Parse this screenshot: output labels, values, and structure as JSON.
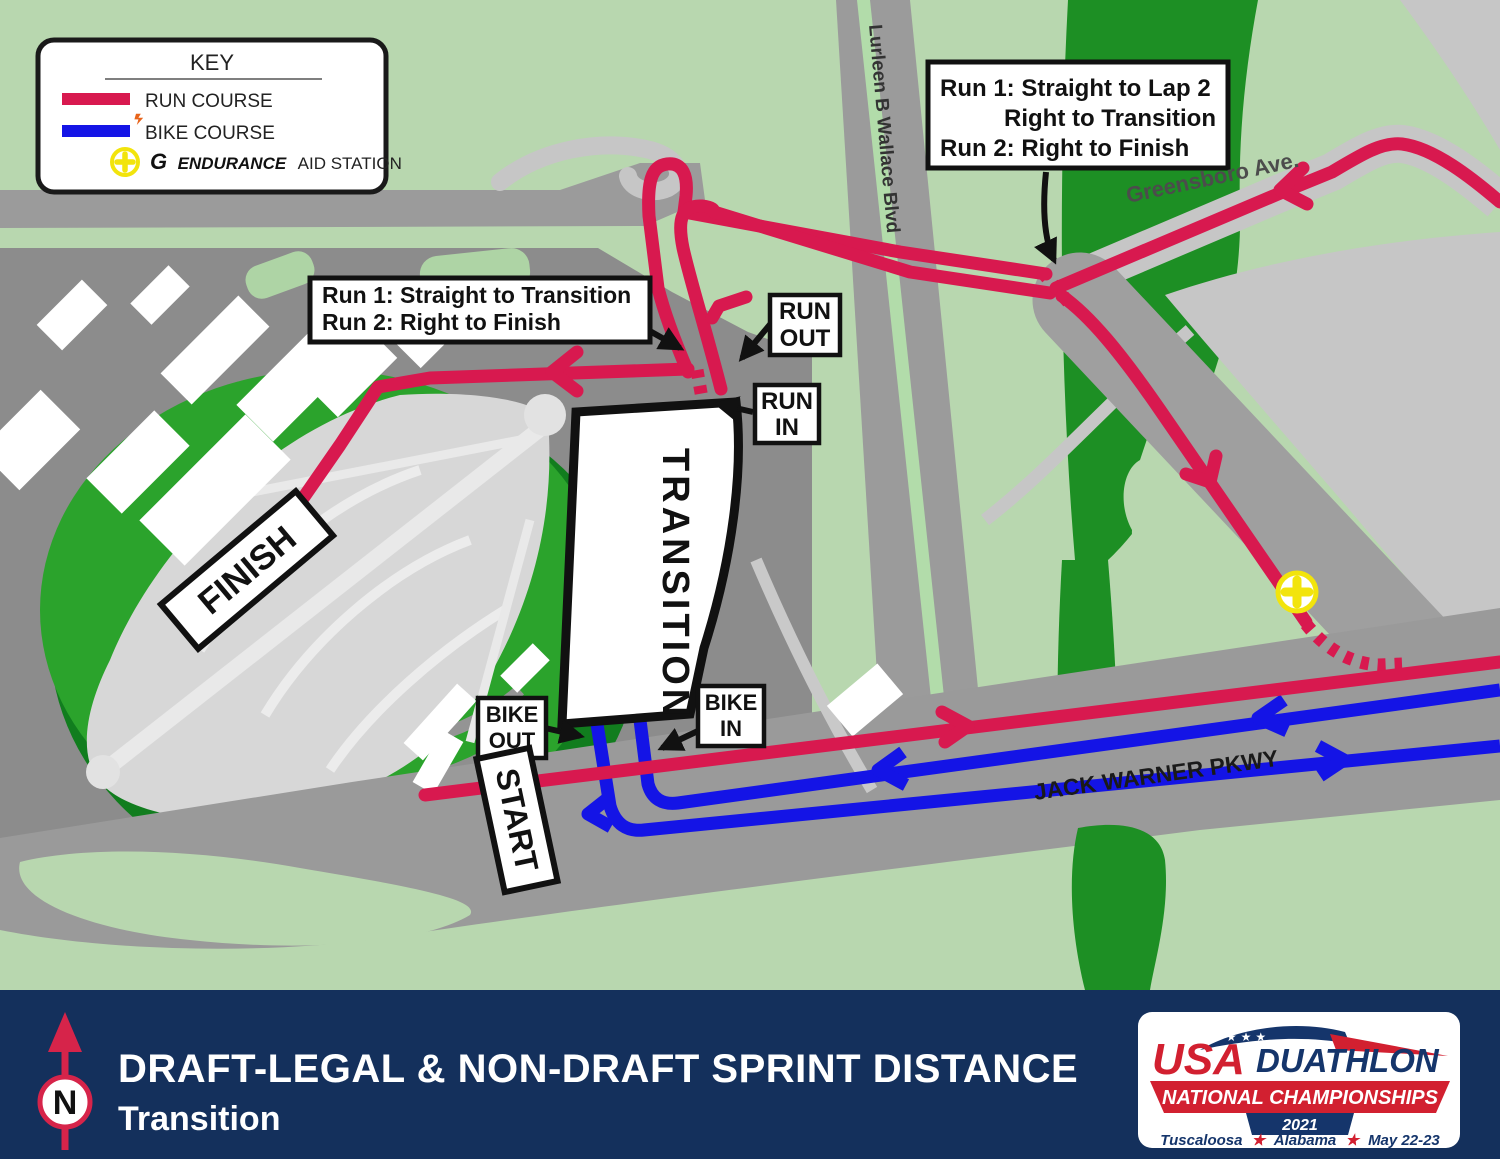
{
  "key": {
    "title": "KEY",
    "run_label": "RUN COURSE",
    "bike_label": "BIKE COURSE",
    "aid_g": "G",
    "aid_brand": "ENDURANCE",
    "aid_rest": "AID STATION"
  },
  "roads": {
    "lurleen": "Lurleen B Wallace Blvd",
    "greensboro": "Greensboro Ave.",
    "jack_warner": "JACK WARNER PKWY"
  },
  "callout_top": {
    "line1": "Run 1: Straight to Lap 2",
    "line2": "Right to Transition",
    "line3": "Run 2: Right to Finish"
  },
  "callout_left": {
    "line1": "Run 1: Straight to Transition",
    "line2": "Run 2: Right to Finish"
  },
  "tags": {
    "run_out_1": "RUN",
    "run_out_2": "OUT",
    "run_in_1": "RUN",
    "run_in_2": "IN",
    "bike_out_1": "BIKE",
    "bike_out_2": "OUT",
    "bike_in_1": "BIKE",
    "bike_in_2": "IN",
    "transition": "TRANSITION",
    "finish": "FINISH",
    "start": "START"
  },
  "footer": {
    "north": "N",
    "title": "DRAFT-LEGAL & NON-DRAFT SPRINT DISTANCE",
    "subtitle": "Transition"
  },
  "logo": {
    "usa": "USA",
    "duathlon": "DUATHLON",
    "banner": "NATIONAL CHAMPIONSHIPS",
    "year": "2021",
    "loc_city": "Tuscaloosa",
    "star": "★",
    "loc_state": "Alabama",
    "loc_dates": "May 22-23"
  },
  "colors": {
    "run_course": "#d8194f",
    "bike_course": "#1414e6",
    "aid_yellow": "#f2e40c",
    "footer_navy": "#14305c",
    "map_green": "#b8d7af",
    "park_green": "#1d8f24",
    "road_gray": "#9a9a9a"
  }
}
